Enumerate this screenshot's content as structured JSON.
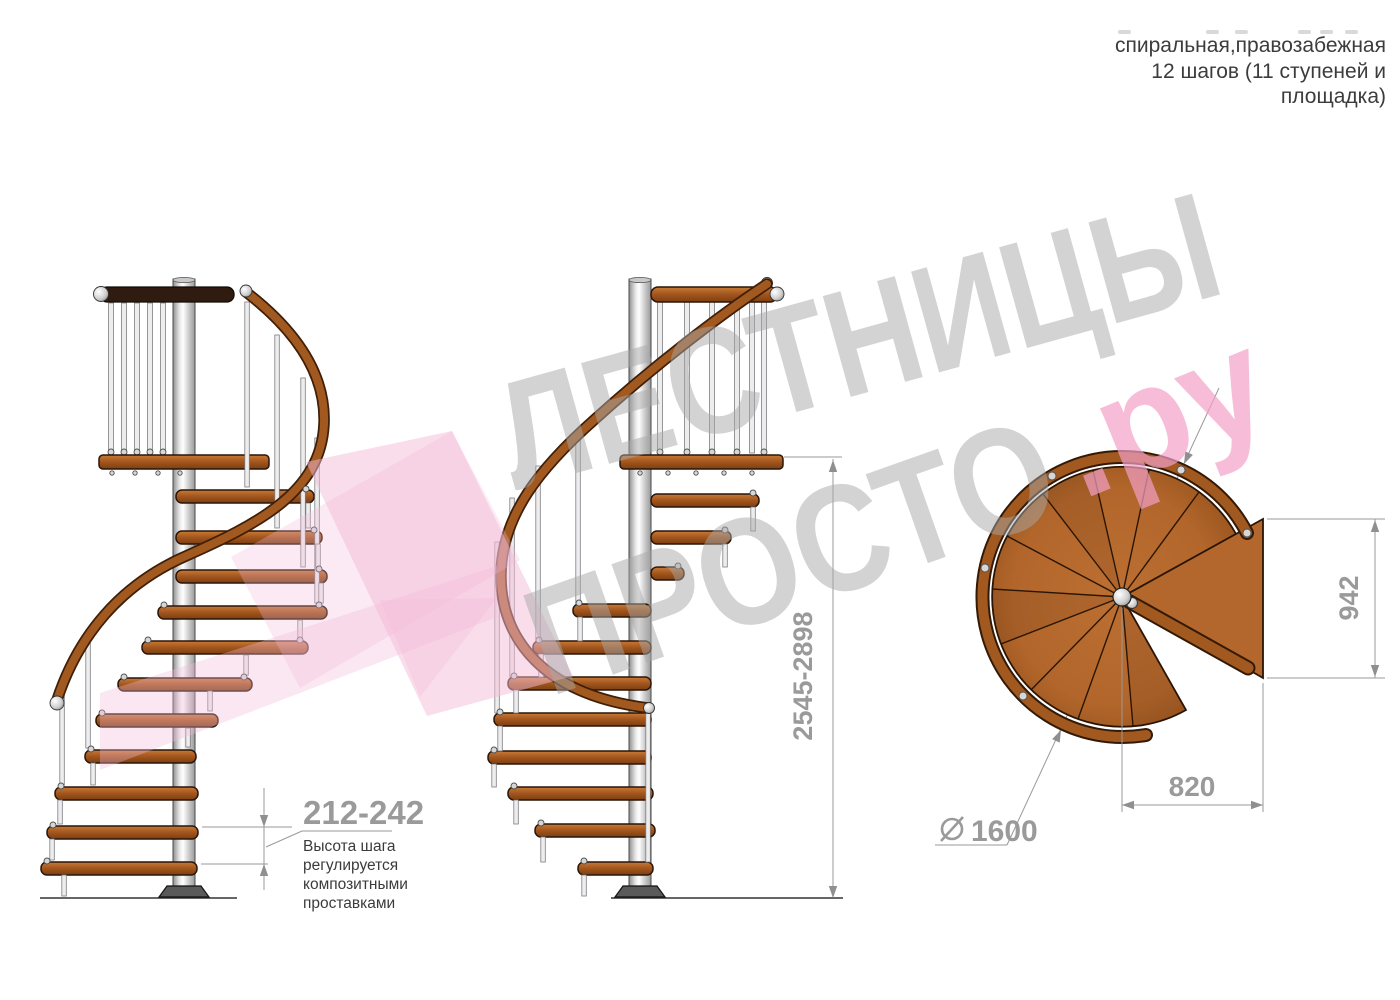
{
  "header": {
    "subtitle_line1": "спиральная,правозабежная",
    "subtitle_line2": "12 шагов (11 ступеней и",
    "subtitle_line3": "площадка)"
  },
  "watermark": {
    "word1": "ЛЕСТНИЦЫ",
    "word2": "ПРОСТО",
    "suffix": ".ру",
    "gray": "#c8c8c8",
    "pink": "#f5b5d5"
  },
  "dimensions": {
    "step_height": "212-242",
    "step_note1": "Высота шага",
    "step_note2": "регулируется",
    "step_note3": "композитными",
    "step_note4": "проставками",
    "total_height": "2545-2898",
    "landing_depth": "942",
    "landing_width": "820",
    "diameter_value": "1600"
  },
  "colors": {
    "wood": "#b2662b",
    "rail": "#a2591f",
    "dark_rail": "#2f1b10",
    "pole": "#d9d9d9",
    "dimension_gray": "#9a9a9a"
  }
}
